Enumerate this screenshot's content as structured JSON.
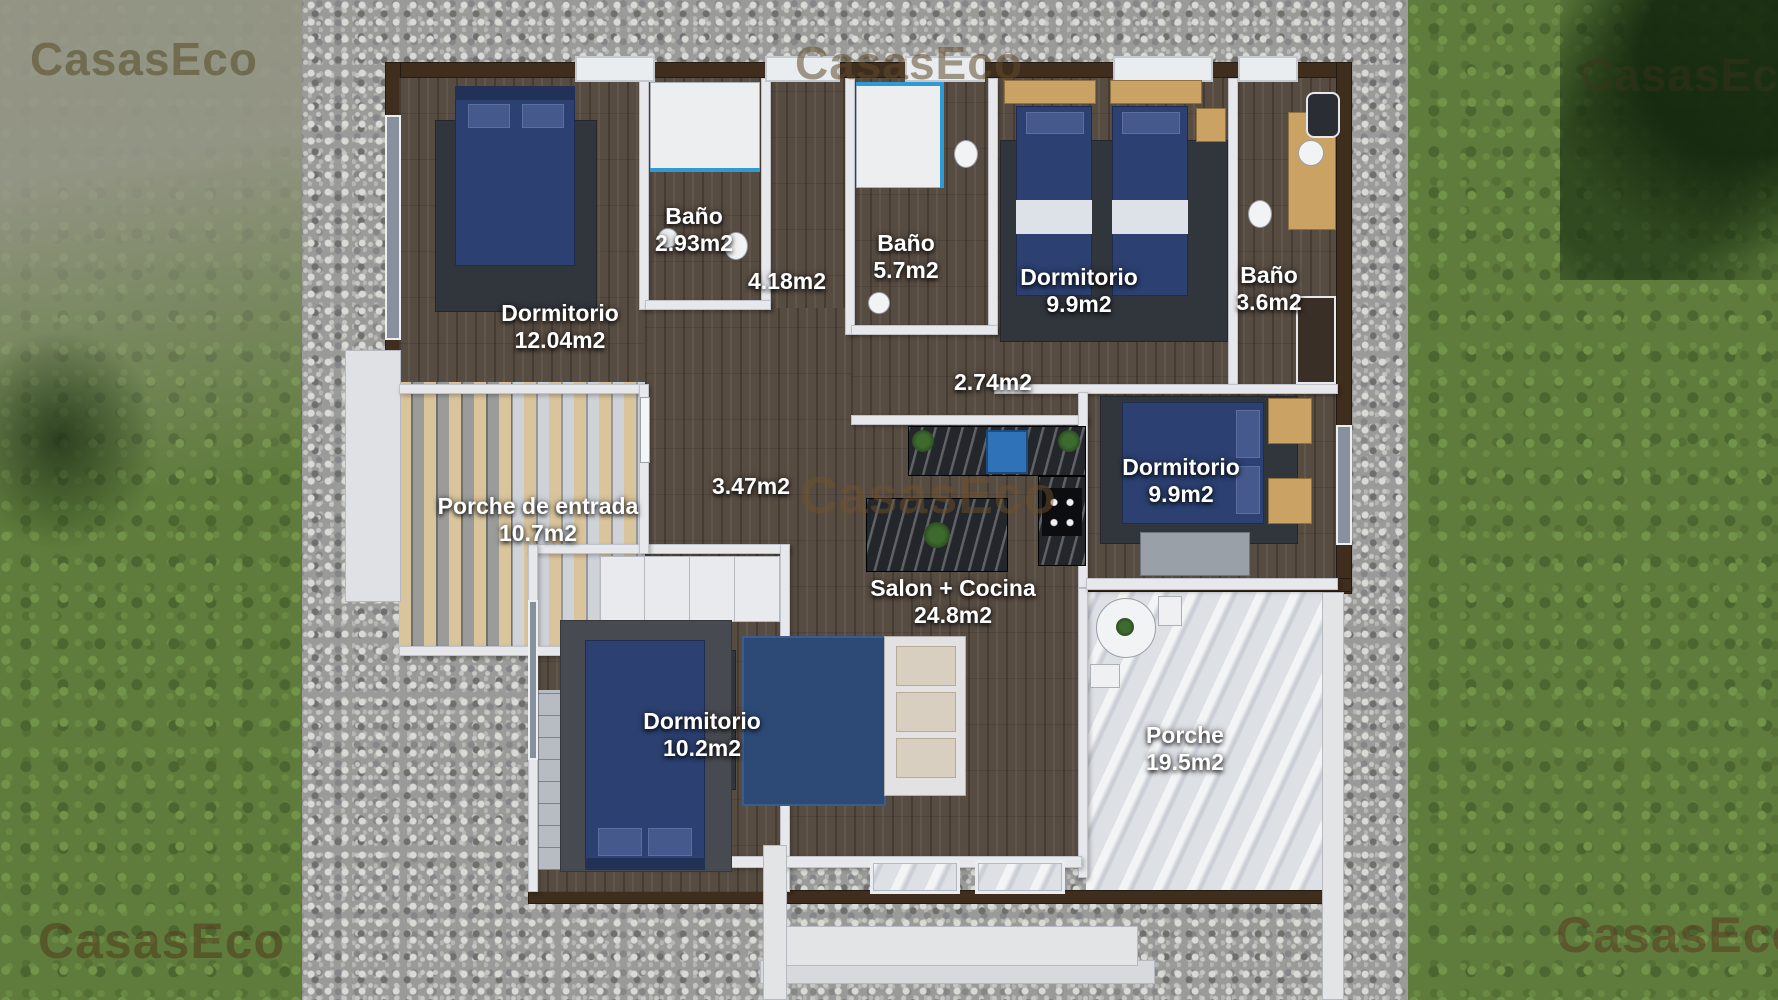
{
  "watermark": {
    "text": "CasasEco"
  },
  "rooms": [
    {
      "id": "dormitorio-12",
      "name": "Dormitorio",
      "area": "12.04m2"
    },
    {
      "id": "bano-293",
      "name": "Baño",
      "area": "2.93m2"
    },
    {
      "id": "pasillo-418",
      "name": "",
      "area": "4.18m2"
    },
    {
      "id": "bano-57",
      "name": "Baño",
      "area": "5.7m2"
    },
    {
      "id": "dormitorio-99-twin",
      "name": "Dormitorio",
      "area": "9.9m2"
    },
    {
      "id": "bano-36",
      "name": "Baño",
      "area": "3.6m2"
    },
    {
      "id": "pasillo-274",
      "name": "",
      "area": "2.74m2"
    },
    {
      "id": "porche-entrada",
      "name": "Porche de entrada",
      "area": "10.7m2"
    },
    {
      "id": "recibidor-347",
      "name": "",
      "area": "3.47m2"
    },
    {
      "id": "dormitorio-99-doble",
      "name": "Dormitorio",
      "area": "9.9m2"
    },
    {
      "id": "salon-cocina",
      "name": "Salon + Cocina",
      "area": "24.8m2"
    },
    {
      "id": "dormitorio-102",
      "name": "Dormitorio",
      "area": "10.2m2"
    },
    {
      "id": "porche",
      "name": "Porche",
      "area": "19.5m2"
    }
  ],
  "colors": {
    "grass": "#5f7c3c",
    "gravel": "#9a9a98",
    "wood_floor": "#574c42",
    "wall": "#e7e8eb",
    "wall_cap": "#3f2d1d",
    "bed_blue": "#2c4071",
    "marble": "#dde0e5",
    "counter_dark": "#23262b",
    "shower_accent": "#2e9ad6",
    "label_text": "#ffffff",
    "watermark_brown": "#6b5a32"
  }
}
